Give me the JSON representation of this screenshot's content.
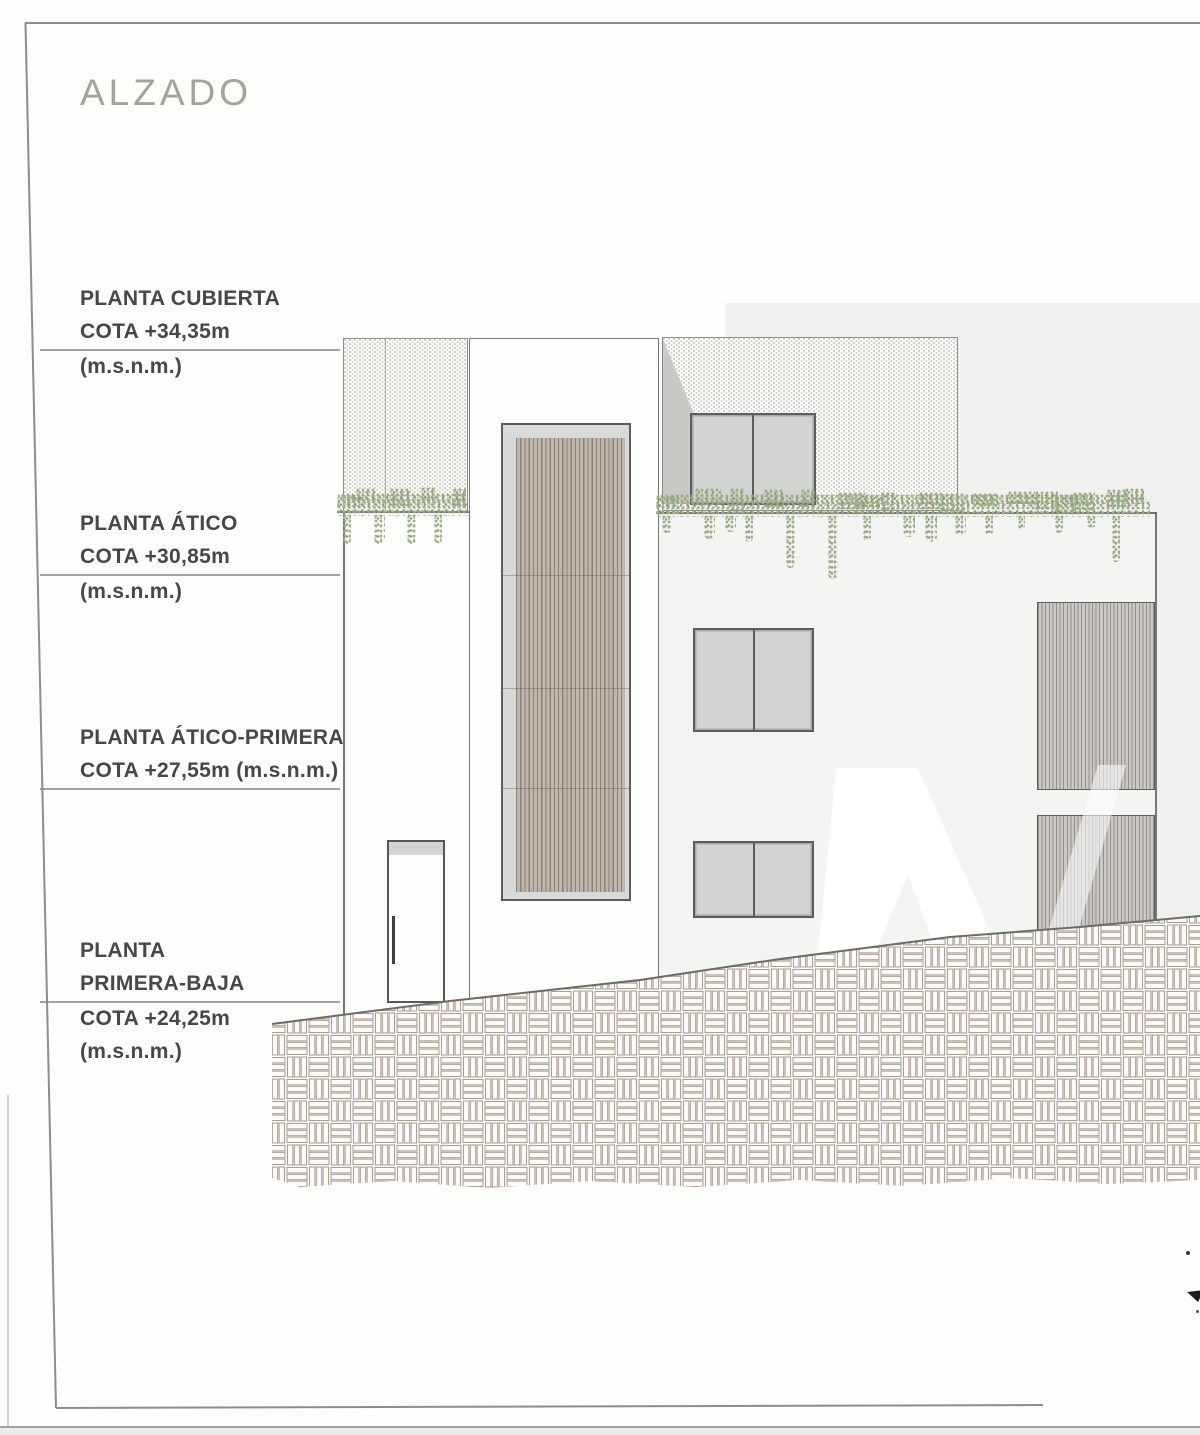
{
  "title": "ALZADO",
  "levels": [
    {
      "lines_above": [
        "PLANTA CUBIERTA",
        "COTA +34,35m"
      ],
      "lines_below": [
        "(m.s.n.m.)"
      ]
    },
    {
      "lines_above": [
        "PLANTA ÁTICO",
        "COTA +30,85m"
      ],
      "lines_below": [
        "(m.s.n.m.)"
      ]
    },
    {
      "lines_above": [
        "PLANTA ÁTICO-PRIMERA",
        "COTA +27,55m (m.s.n.m.)"
      ],
      "lines_below": []
    },
    {
      "lines_above": [
        "PLANTA",
        "PRIMERA-BAJA"
      ],
      "lines_below": [
        "COTA +24,25m",
        "(m.s.n.m.)"
      ]
    }
  ],
  "colors": {
    "page": "#fdfdfc",
    "title_text": "#a6a29a",
    "label_text": "#474745",
    "level_line": "#a2a29e",
    "outline": "#767672",
    "frame": "#8d8d89",
    "background_block": "#f0f0ee",
    "wall": "#f4f4f2",
    "glass": "#d2d4d1",
    "window_frame": "#5b5e5c",
    "louver_face": "#d8dad7",
    "louver_slat": "#bfb6ac",
    "louver_slat_line": "#8d8276",
    "right_louver": "#cac8c4",
    "right_louver_line": "#94908a",
    "vegetation_main": "#9cab86",
    "vegetation_dark": "#869b70",
    "ground_line": "#6b6b67",
    "ground_hatch_line": "#a99b8f",
    "shadow": "#c8cac6",
    "stipple": "#c6c6c2",
    "watermark": "#ffffff"
  }
}
